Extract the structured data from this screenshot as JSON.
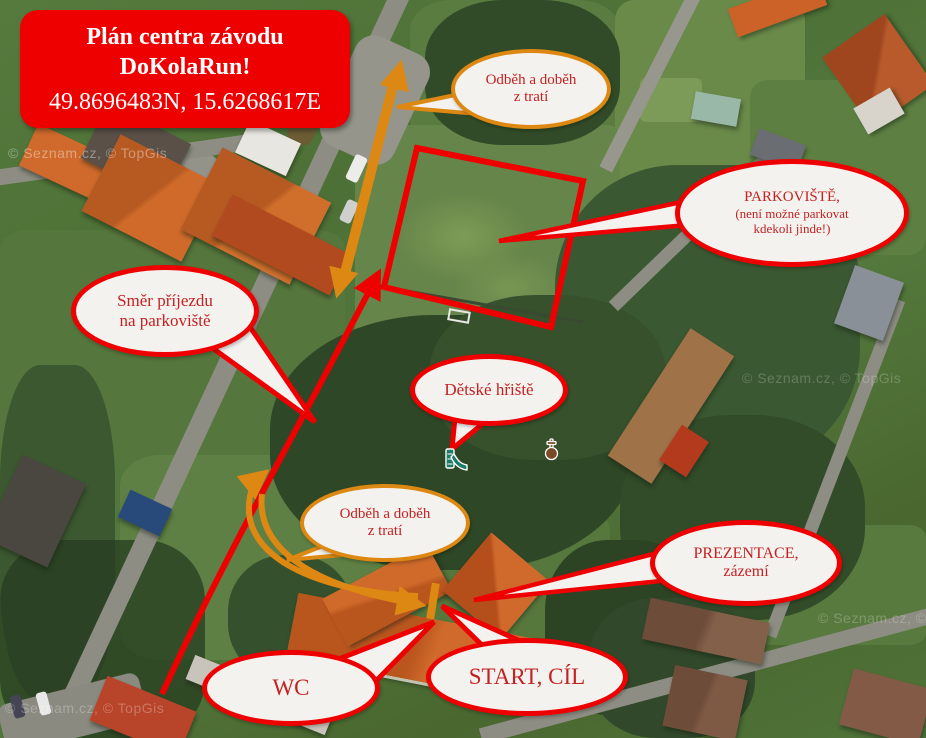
{
  "attribution": "© Seznam.cz, © TopGis",
  "title_box": {
    "line1": "Plán centra závodu",
    "line2": "DoKolaRun!",
    "coordinates": "49.8696483N, 15.6268617E"
  },
  "callouts": {
    "odbeh_top": {
      "line1": "Odběh a doběh",
      "line2": "z tratí"
    },
    "parkoviste": {
      "line1": "PARKOVIŠTĚ,",
      "line2": "(není možné parkovat",
      "line3": "kdekoli jinde!)"
    },
    "smer_prijezdu": {
      "line1": "Směr příjezdu",
      "line2": "na parkoviště"
    },
    "detske_hriste": {
      "label": "Dětské hřiště"
    },
    "odbeh_mid": {
      "line1": "Odběh a doběh",
      "line2": "z tratí"
    },
    "prezentace": {
      "line1": "PREZENTACE,",
      "line2": "zázemí"
    },
    "wc": {
      "label": "WC"
    },
    "start_cil": {
      "label": "START, CÍL"
    }
  },
  "icons": {
    "playground": "playground-slide",
    "monument": "cross-monument"
  },
  "colors": {
    "annotation_red": "#ee0000",
    "annotation_orange": "#dd8812",
    "bubble_fill": "#f4f2ef",
    "callout_text_red": "#c32222",
    "title_bg": "#ee0000",
    "title_text": "#ffffff"
  }
}
